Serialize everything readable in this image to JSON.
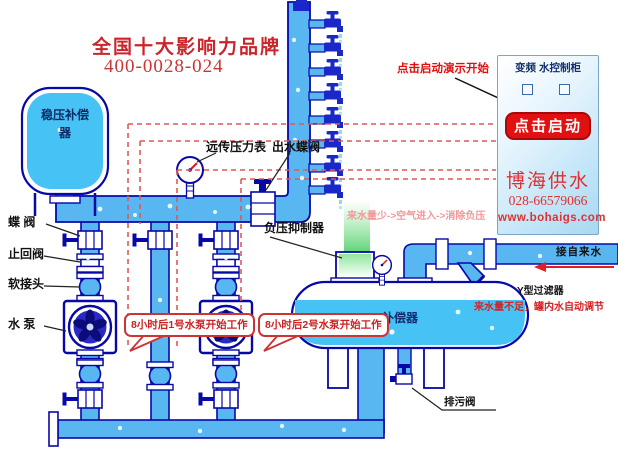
{
  "header": {
    "brand_title": "全国十大影响力品牌",
    "phone": "400-0028-024"
  },
  "equipment_labels": {
    "surge_tank": "稳压补偿器",
    "butterfly_valve": "蝶  阀",
    "check_valve": "止回阀",
    "soft_joint": "软接头",
    "water_pump": "水  泵",
    "remote_pressure_gauge": "远传压力表",
    "outlet_butterfly_valve": "出水蝶阀",
    "negative_pressure_suppressor": "负压抑制器",
    "compensator": "补偿器",
    "drain_valve": "排污阀",
    "y_filter": "Y型过滤器",
    "tap_water_inlet": "接自来水"
  },
  "annotations": {
    "demo_hint": "点击启动演示开始",
    "air_flow_note": "来水量少->空气进入->消除负压",
    "low_water_note": "来水量不足，罐内水自动调节",
    "pump1_callout": "8小时后1号水泵开始工作",
    "pump2_callout": "8小时后2号水泵开始工作"
  },
  "control_cabinet": {
    "title": "变频  水控制柜",
    "start_button": "点击启动",
    "company": "博海供水",
    "phone": "028-66579066",
    "website": "www.bohaigs.com"
  },
  "icons": {
    "faucet-icon": "navy tap glyph with T-handle and drip",
    "butterfly-valve-icon": "white flanged box with side T-handle",
    "check-valve-icon": "double-flange coupling",
    "soft-joint-icon": "flanged bulge",
    "pump-impeller-icon": "circle with 5 navy blades",
    "pressure-gauge-icon": "dial with red needle",
    "y-filter-icon": "diagonal strainer stub",
    "drain-valve-icon": "small tap at tank bottom",
    "indicator-box-icon": "small square lamp"
  },
  "colors": {
    "pipe_fill": "#58b6f0",
    "pipe_outline": "#0808a8",
    "water_fill": "#47c2f4",
    "accent_red": "#d42222",
    "button_red": "#e21010",
    "dashed_signal": "#e05858",
    "pink_note": "#f2989a",
    "green_glow": "#58d858",
    "cabinet_blue": "#bfe4f8"
  }
}
